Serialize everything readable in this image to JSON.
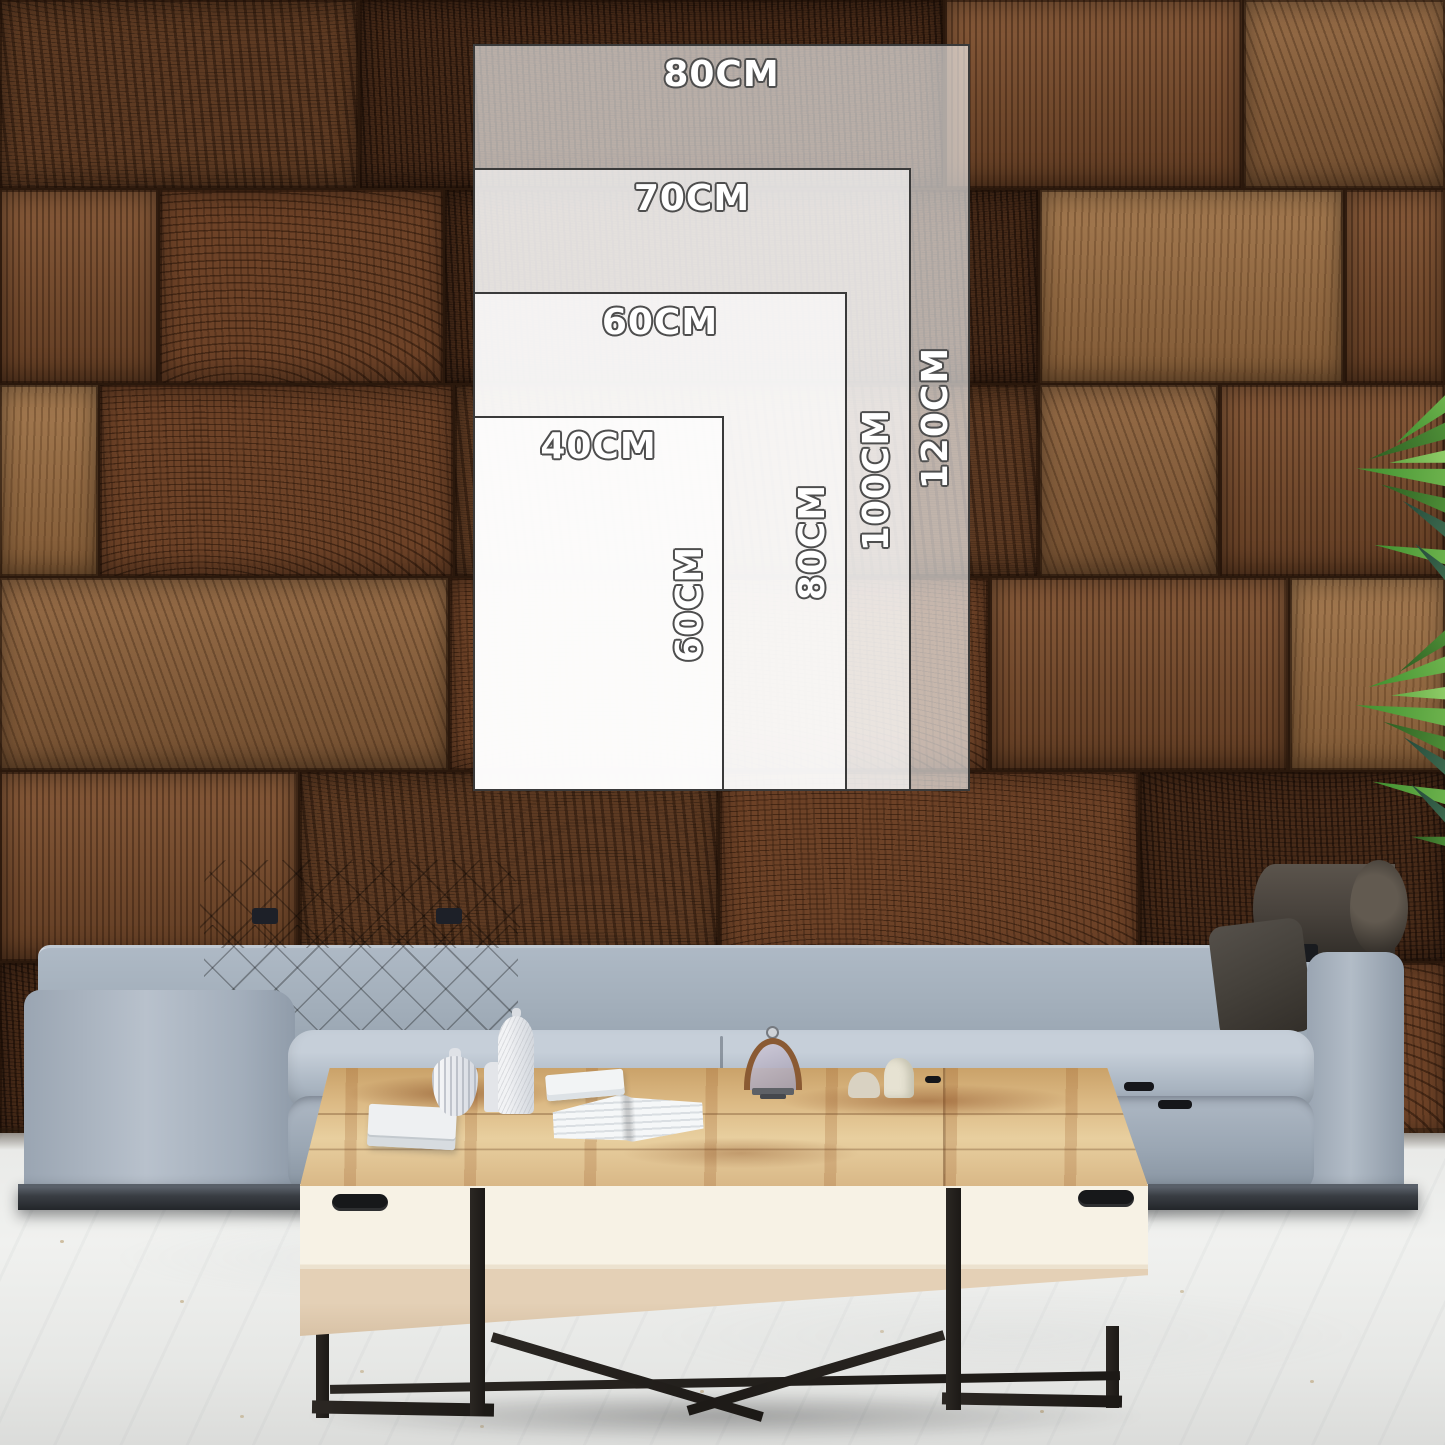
{
  "product_mockup": {
    "sizes": [
      {
        "name": "80x120",
        "width_label": "80CM",
        "height_label": "120CM"
      },
      {
        "name": "70x100",
        "width_label": "70CM",
        "height_label": "100CM"
      },
      {
        "name": "60x80",
        "width_label": "60CM",
        "height_label": "80CM"
      },
      {
        "name": "40x60",
        "width_label": "40CM",
        "height_label": "60CM"
      }
    ],
    "colors": {
      "overlay_fill": "rgba(255,255,255,0.62)",
      "overlay_border": "#3a3a3a",
      "label_fill": "#ffffff",
      "label_outline": "#4e4e4e",
      "wall_wood": "#6d4227",
      "sofa_fabric": "#a2aeba",
      "headrest_fabric": "#3c4350",
      "table_wood": "#dcba85",
      "table_front": "#f2ead9",
      "metal_legs": "#1f1d1b",
      "plant_green": "#4f9038",
      "floor": "#ecedeb"
    }
  }
}
